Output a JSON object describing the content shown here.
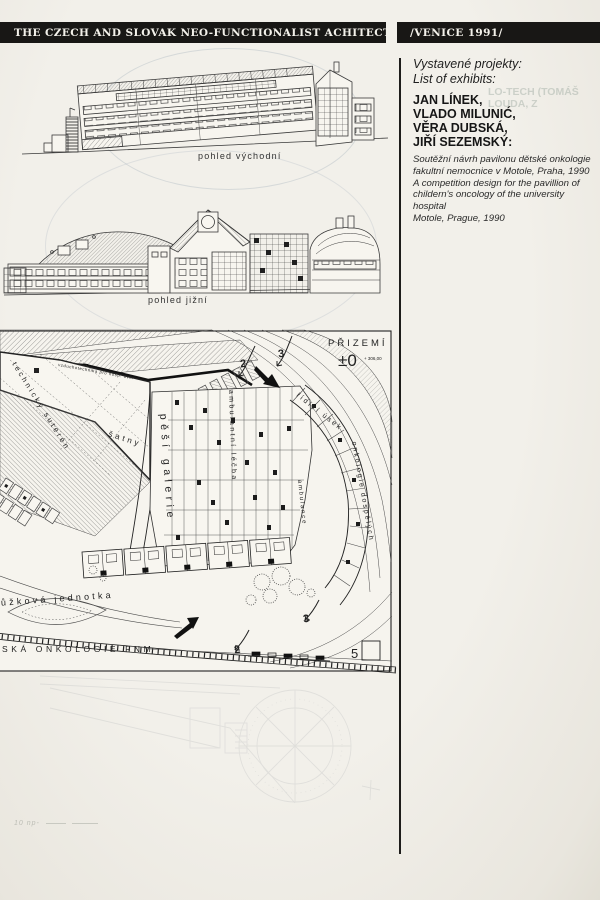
{
  "header": {
    "left_title": "THE CZECH AND SLOVAK NEO-FUNCTIONALIST ACHITECTURE",
    "right_title": "/VENICE 1991/"
  },
  "exhibits": {
    "intro_lines": [
      "Vystavené projekty:",
      "List of exhibits:"
    ],
    "architects": [
      "JAN LÍNEK,",
      "VLADO MILUNIĆ,",
      "VĚRA DUBSKÁ,",
      "JIŘÍ SEZEMSKÝ:"
    ],
    "description_cs_lines": [
      "Soutěžní návrh pavilonu dětské onkologie",
      "fakultní nemocnice v Motole, Praha, 1990"
    ],
    "description_en_lines": [
      "A competition design for the pavillion of",
      "childern's oncology of the university hospital",
      "Motole, Prague, 1990"
    ],
    "ghost_lines": [
      "LO-TECH (TOMÁŠ",
      "LOUDA, Z"
    ]
  },
  "elevations": {
    "east_caption": "pohled východní",
    "south_caption": "pohled jižní"
  },
  "plan": {
    "title": "PŘIZEMÍ",
    "level": "±0",
    "level_note": "+ 306,00",
    "sheet_number": "5",
    "labels": {
      "technical_basement": "technický suterén",
      "air_handling": "vzduchotechnika pro hosp. dvůr",
      "cloakrooms": "šatny",
      "outpatient": "ambulantní léčba",
      "gallery": "pěší galerie",
      "management": "řídící úsek",
      "adult_oncology": "onkologie dospělých",
      "ambulance": "ambulance",
      "bed_unit": "lůžková jednotka",
      "street": "SKÁ ONKOLOGIE FNM"
    },
    "arrow_numbers": {
      "top_a": "2",
      "top_b": "3",
      "bottom_a": "2",
      "bottom_b": "3"
    }
  },
  "pencil_note": "10 np-"
}
